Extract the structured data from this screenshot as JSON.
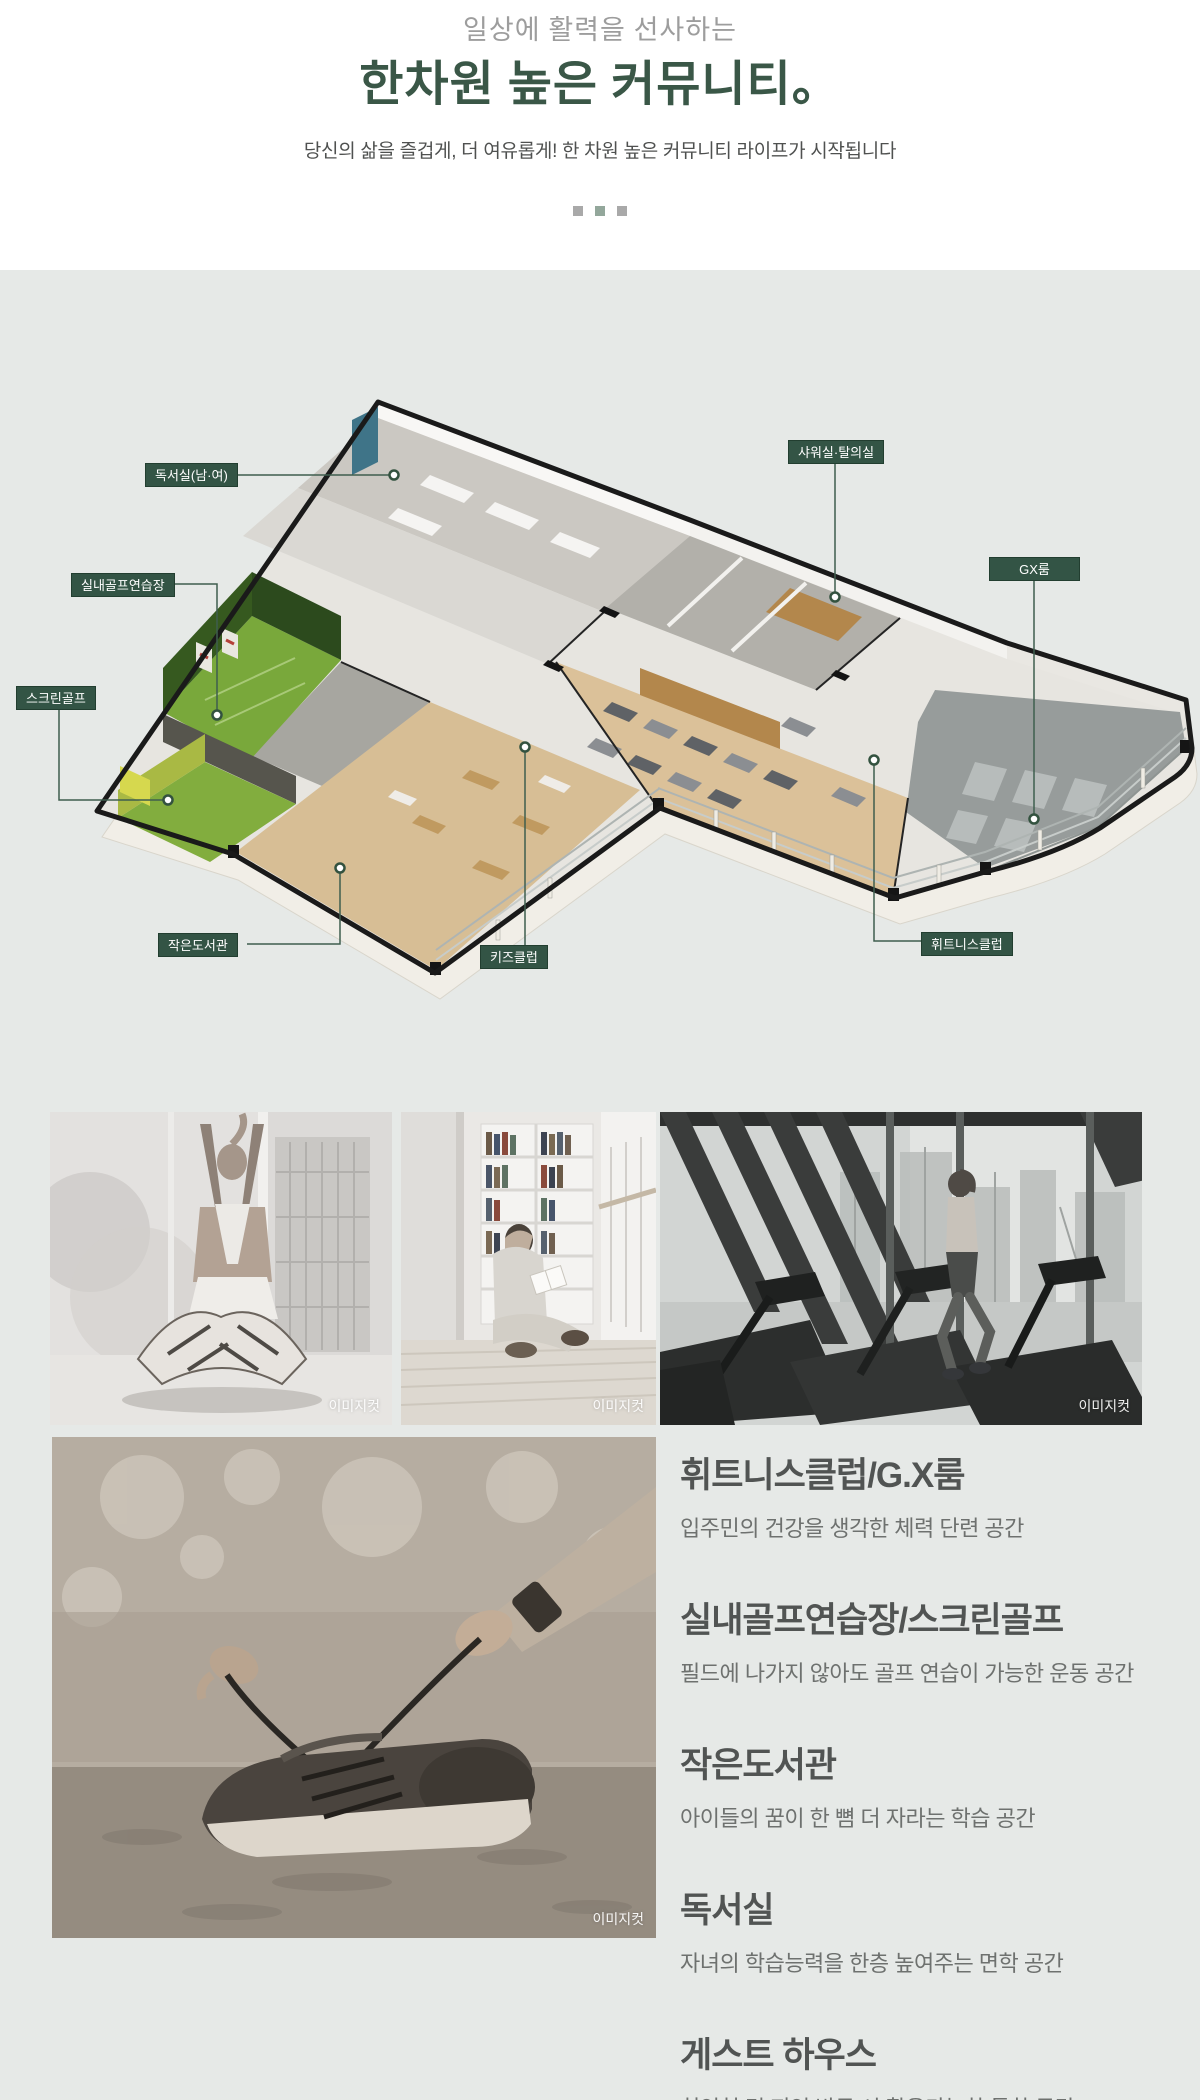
{
  "header": {
    "eyebrow": "일상에 활력을 선사하는",
    "title": "한차원 높은 커뮤니티。",
    "description": "당신의 삶을 즐겁게, 더 여유롭게! 한 차원 높은 커뮤니티 라이프가 시작됩니다"
  },
  "floorplan": {
    "labels": [
      {
        "id": "reading-room",
        "text": "독서실(남·여)"
      },
      {
        "id": "indoor-golf",
        "text": "실내골프연습장"
      },
      {
        "id": "screen-golf",
        "text": "스크린골프"
      },
      {
        "id": "small-library",
        "text": "작은도서관"
      },
      {
        "id": "kids-club",
        "text": "키즈클럽"
      },
      {
        "id": "shower-locker",
        "text": "샤워실·탈의실"
      },
      {
        "id": "gx-room",
        "text": "GX룸"
      },
      {
        "id": "fitness-club",
        "text": "휘트니스클럽"
      }
    ]
  },
  "photos": [
    {
      "name": "yoga-stretch",
      "caption": "이미지컷"
    },
    {
      "name": "library-reading",
      "caption": "이미지컷"
    },
    {
      "name": "treadmill-run",
      "caption": "이미지컷"
    },
    {
      "name": "shoe-tying",
      "caption": "이미지컷"
    }
  ],
  "features": [
    {
      "title": "휘트니스클럽/G.X룸",
      "description": "입주민의 건강을 생각한 체력 단련 공간"
    },
    {
      "title": "실내골프연습장/스크린골프",
      "description": "필드에 나가지 않아도 골프 연습이 가능한 운동 공간"
    },
    {
      "title": "작은도서관",
      "description": "아이들의 꿈이 한 뼘 더 자라는 학습 공간"
    },
    {
      "title": "독서실",
      "description": "자녀의 학습능력을 한층 높여주는 면학 공간"
    },
    {
      "title": "게스트 하우스",
      "description": "친인척 및 지인 방문 시 활용가능한 특화 공간"
    }
  ],
  "colors": {
    "accent_green": "#335445",
    "title_green": "#3a5747",
    "section_bg": "#e6e9e7"
  }
}
